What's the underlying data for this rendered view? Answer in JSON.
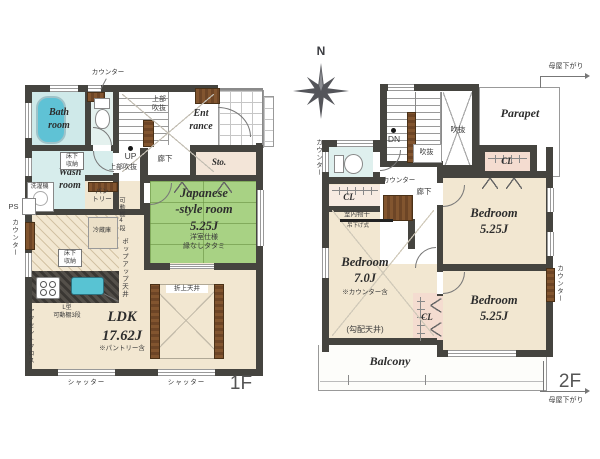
{
  "colors": {
    "wall": "#45443f",
    "tatami_green": "#a8d284",
    "water_blue": "#5fc2d5",
    "wood_brown": "#7a4e2b",
    "closet_pink": "#f4dcd0",
    "floor_beige": "#f2e7d1",
    "bath_blue": "#cfe9e9"
  },
  "compass": {
    "n": "N"
  },
  "floor1": {
    "label": "1F",
    "counter_top": "カウンター",
    "bath": "Bath\nroom",
    "wash": "Wash\nroom",
    "washer": "洗濯機",
    "underfloor_storage": "床下\n収納",
    "underfloor_storage2": "床下\n収納",
    "ps": "PS",
    "counter_left": "カウンター",
    "pantry": "パン\nトリー",
    "movable_shelf": "可動棚4段",
    "fridge": "冷蔵庫",
    "popup_ceiling": "ポップアップ天井",
    "l_shelf": "L型\n可動棚3段",
    "accent_cloth": "アクセントクロス",
    "ldk": "LDK\n17.62J",
    "ldk_note": "※パントリー含",
    "coffered": "折上天井",
    "jp_room": "Japanese\n-style room\n5.25J",
    "jp_note": "洋室仕様\n縁なしタタミ",
    "hall": "廊下",
    "storage": "Sto.",
    "entrance": "Ent\nrance",
    "void_v": "上部\n吹抜",
    "void_h": "上部吹抜",
    "up": "UP",
    "shutter1": "シャッター",
    "shutter2": "シャッター"
  },
  "floor2": {
    "label": "2F",
    "parapet": "Parapet",
    "dn": "DN",
    "void_large": "吹抜",
    "void_small": "吹抜",
    "counter_wc": "カウンター",
    "counter_hall": "カウンター",
    "counter_e": "カウンター",
    "hall": "廊下",
    "cl_w": "CL",
    "cl_mid": "CL",
    "cl_ne": "CL",
    "indoor_drying": "室内物干",
    "hanging": "吊下げ式",
    "bedroom_w": "Bedroom\n7.0J",
    "bedroom_w_note": "※カウンター含",
    "sloped_ceiling": "(勾配天井)",
    "bedroom_ne": "Bedroom\n5.25J",
    "bedroom_se": "Bedroom\n5.25J",
    "balcony": "Balcony",
    "roof_down_top": "母屋下がり",
    "roof_down_bottom": "母屋下がり"
  }
}
